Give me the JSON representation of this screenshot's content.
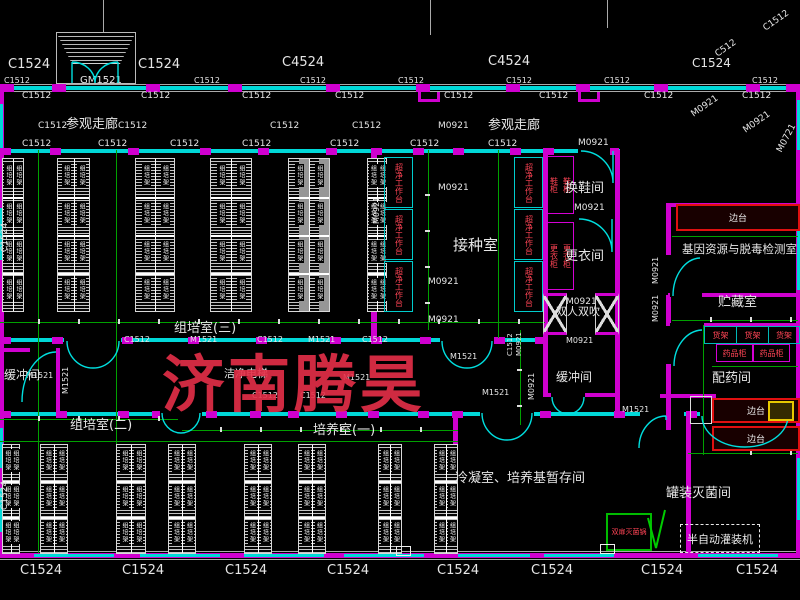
{
  "watermark": {
    "text": "济南腾昊",
    "color": "rgba(229,47,72,0.9)"
  },
  "rack_label": "组培架",
  "colors": {
    "wall_cyan": "#00d8d8",
    "wall_magenta": "#cf00cf",
    "dim_green": "#00a000",
    "equip_red": "#ff4455",
    "bench_red": "#e01010",
    "watermark_red": "#e52f48"
  },
  "room_labels": [
    {
      "text": "参观走廊",
      "x": 66,
      "y": 118,
      "size": 13
    },
    {
      "text": "参观走廊",
      "x": 488,
      "y": 119,
      "size": 13
    },
    {
      "text": "接种室",
      "x": 453,
      "y": 238,
      "size": 15
    },
    {
      "text": "换鞋间",
      "x": 565,
      "y": 182,
      "size": 13
    },
    {
      "text": "更衣间",
      "x": 565,
      "y": 250,
      "size": 13
    },
    {
      "text": "双人双吹",
      "x": 556,
      "y": 306,
      "size": 11
    },
    {
      "text": "缓冲间",
      "x": 556,
      "y": 371,
      "size": 12
    },
    {
      "text": "缓冲间",
      "x": 4,
      "y": 369,
      "size": 12
    },
    {
      "text": "洁净电梯",
      "x": 224,
      "y": 368,
      "size": 11
    },
    {
      "text": "组培室(三)",
      "x": 174,
      "y": 322,
      "size": 13
    },
    {
      "text": "组培室(二)",
      "x": 70,
      "y": 419,
      "size": 13
    },
    {
      "text": "培养室(一)",
      "x": 313,
      "y": 424,
      "size": 13
    },
    {
      "text": "冷凝室、培养基暂存间",
      "x": 455,
      "y": 472,
      "size": 13
    },
    {
      "text": "罐装灭菌间",
      "x": 666,
      "y": 487,
      "size": 13
    },
    {
      "text": "基因资源与脱毒检测室",
      "x": 682,
      "y": 244,
      "size": 11.5
    },
    {
      "text": "贮藏室",
      "x": 718,
      "y": 296,
      "size": 13
    },
    {
      "text": "配药间",
      "x": 712,
      "y": 372,
      "size": 13
    }
  ],
  "dim_labels": [
    {
      "text": "C1524",
      "x": 8,
      "y": 58,
      "size": 13
    },
    {
      "text": "C1524",
      "x": 138,
      "y": 58,
      "size": 13
    },
    {
      "text": "C4524",
      "x": 282,
      "y": 56,
      "size": 13
    },
    {
      "text": "C4524",
      "x": 488,
      "y": 55,
      "size": 13
    },
    {
      "text": "C1524",
      "x": 692,
      "y": 57,
      "size": 12
    },
    {
      "text": "C512",
      "x": 714,
      "y": 52,
      "size": 9,
      "rot": -35
    },
    {
      "text": "C1512",
      "x": 762,
      "y": 26,
      "size": 9,
      "rot": -35
    },
    {
      "text": "GM1521",
      "x": 80,
      "y": 76,
      "size": 10
    },
    {
      "text": "C1512",
      "x": 4,
      "y": 77,
      "size": 8
    },
    {
      "text": "C1512",
      "x": 194,
      "y": 77,
      "size": 8
    },
    {
      "text": "C1512",
      "x": 300,
      "y": 77,
      "size": 8
    },
    {
      "text": "C1512",
      "x": 398,
      "y": 77,
      "size": 8
    },
    {
      "text": "C1512",
      "x": 506,
      "y": 77,
      "size": 8
    },
    {
      "text": "C1512",
      "x": 604,
      "y": 77,
      "size": 8
    },
    {
      "text": "C1512",
      "x": 752,
      "y": 77,
      "size": 8
    },
    {
      "text": "C1512",
      "x": 22,
      "y": 92,
      "size": 9
    },
    {
      "text": "C1512",
      "x": 141,
      "y": 92,
      "size": 9
    },
    {
      "text": "C1512",
      "x": 242,
      "y": 92,
      "size": 9
    },
    {
      "text": "C1512",
      "x": 335,
      "y": 92,
      "size": 9
    },
    {
      "text": "C1512",
      "x": 444,
      "y": 92,
      "size": 9
    },
    {
      "text": "C1512",
      "x": 539,
      "y": 92,
      "size": 9
    },
    {
      "text": "C1512",
      "x": 644,
      "y": 92,
      "size": 9
    },
    {
      "text": "C1512",
      "x": 742,
      "y": 92,
      "size": 9
    },
    {
      "text": "C1512",
      "x": 38,
      "y": 122,
      "size": 9
    },
    {
      "text": "C1512",
      "x": 118,
      "y": 122,
      "size": 9
    },
    {
      "text": "C1512",
      "x": 270,
      "y": 122,
      "size": 9
    },
    {
      "text": "C1512",
      "x": 352,
      "y": 122,
      "size": 9
    },
    {
      "text": "M0921",
      "x": 438,
      "y": 122,
      "size": 9
    },
    {
      "text": "C1512",
      "x": 22,
      "y": 140,
      "size": 9
    },
    {
      "text": "C1512",
      "x": 98,
      "y": 140,
      "size": 9
    },
    {
      "text": "C1512",
      "x": 170,
      "y": 140,
      "size": 9
    },
    {
      "text": "C1512",
      "x": 242,
      "y": 140,
      "size": 9
    },
    {
      "text": "C1512",
      "x": 330,
      "y": 140,
      "size": 9
    },
    {
      "text": "C1512",
      "x": 410,
      "y": 140,
      "size": 9
    },
    {
      "text": "C1512",
      "x": 488,
      "y": 140,
      "size": 9
    },
    {
      "text": "M0921",
      "x": 578,
      "y": 139,
      "size": 9
    },
    {
      "text": "M0921",
      "x": 690,
      "y": 112,
      "size": 9,
      "rot": -35
    },
    {
      "text": "M0921",
      "x": 742,
      "y": 128,
      "size": 9,
      "rot": -35
    },
    {
      "text": "M0721",
      "x": 776,
      "y": 150,
      "size": 9,
      "rot": -62
    },
    {
      "text": "M0921",
      "x": 438,
      "y": 184,
      "size": 9
    },
    {
      "text": "M0921",
      "x": 574,
      "y": 204,
      "size": 9
    },
    {
      "text": "M0921",
      "x": 566,
      "y": 298,
      "size": 9
    },
    {
      "text": "M0921",
      "x": 428,
      "y": 278,
      "size": 9
    },
    {
      "text": "M0921",
      "x": 428,
      "y": 316,
      "size": 9
    },
    {
      "text": "M0921",
      "x": 566,
      "y": 337,
      "size": 8
    },
    {
      "text": "C1512",
      "x": 124,
      "y": 336,
      "size": 8
    },
    {
      "text": "M1521",
      "x": 190,
      "y": 336,
      "size": 8
    },
    {
      "text": "C1512",
      "x": 257,
      "y": 336,
      "size": 8
    },
    {
      "text": "M1521",
      "x": 308,
      "y": 336,
      "size": 8
    },
    {
      "text": "C1512",
      "x": 362,
      "y": 336,
      "size": 8
    },
    {
      "text": "M1521",
      "x": 450,
      "y": 353,
      "size": 8
    },
    {
      "text": "M1521",
      "x": 482,
      "y": 389,
      "size": 8
    },
    {
      "text": "M1521",
      "x": 622,
      "y": 406,
      "size": 8
    },
    {
      "text": "M1521",
      "x": 26,
      "y": 372,
      "size": 8
    },
    {
      "text": "C1512",
      "x": 252,
      "y": 392,
      "size": 8
    },
    {
      "text": "C1512",
      "x": 300,
      "y": 392,
      "size": 8
    },
    {
      "text": "M1521",
      "x": 343,
      "y": 374,
      "size": 8
    },
    {
      "text": "C1524",
      "x": 20,
      "y": 564,
      "size": 13
    },
    {
      "text": "C1524",
      "x": 122,
      "y": 564,
      "size": 13
    },
    {
      "text": "C1524",
      "x": 225,
      "y": 564,
      "size": 13
    },
    {
      "text": "C1524",
      "x": 327,
      "y": 564,
      "size": 13
    },
    {
      "text": "C1524",
      "x": 437,
      "y": 564,
      "size": 13
    },
    {
      "text": "C1524",
      "x": 531,
      "y": 564,
      "size": 13
    },
    {
      "text": "C1524",
      "x": 641,
      "y": 564,
      "size": 13
    },
    {
      "text": "C1524",
      "x": 736,
      "y": 564,
      "size": 13
    }
  ],
  "vdim_labels": [
    {
      "text": "M1521",
      "x": 62,
      "y": 394,
      "size": 8
    },
    {
      "text": "M0921",
      "x": 528,
      "y": 400,
      "size": 8
    },
    {
      "text": "C1512",
      "x": 507,
      "y": 356,
      "size": 7
    },
    {
      "text": "M0921",
      "x": 516,
      "y": 356,
      "size": 7
    },
    {
      "text": "M0921",
      "x": 652,
      "y": 284,
      "size": 8
    },
    {
      "text": "M0921",
      "x": 652,
      "y": 322,
      "size": 8
    },
    {
      "text": "M0921",
      "x": 373,
      "y": 224,
      "size": 8
    },
    {
      "text": "C1524",
      "x": 1,
      "y": 252,
      "size": 9
    },
    {
      "text": "C1524",
      "x": 1,
      "y": 510,
      "size": 9
    }
  ],
  "equipment": {
    "clean_bench": "超净工作台",
    "shoe_cabinet": "鞋柜",
    "wardrobe": "更衣柜",
    "shelf": "货架",
    "medicine_cabinet": "药品柜",
    "side_bench": "边台",
    "sterilizer": "双扉灭菌锅",
    "filler": "半自动灌装机"
  }
}
